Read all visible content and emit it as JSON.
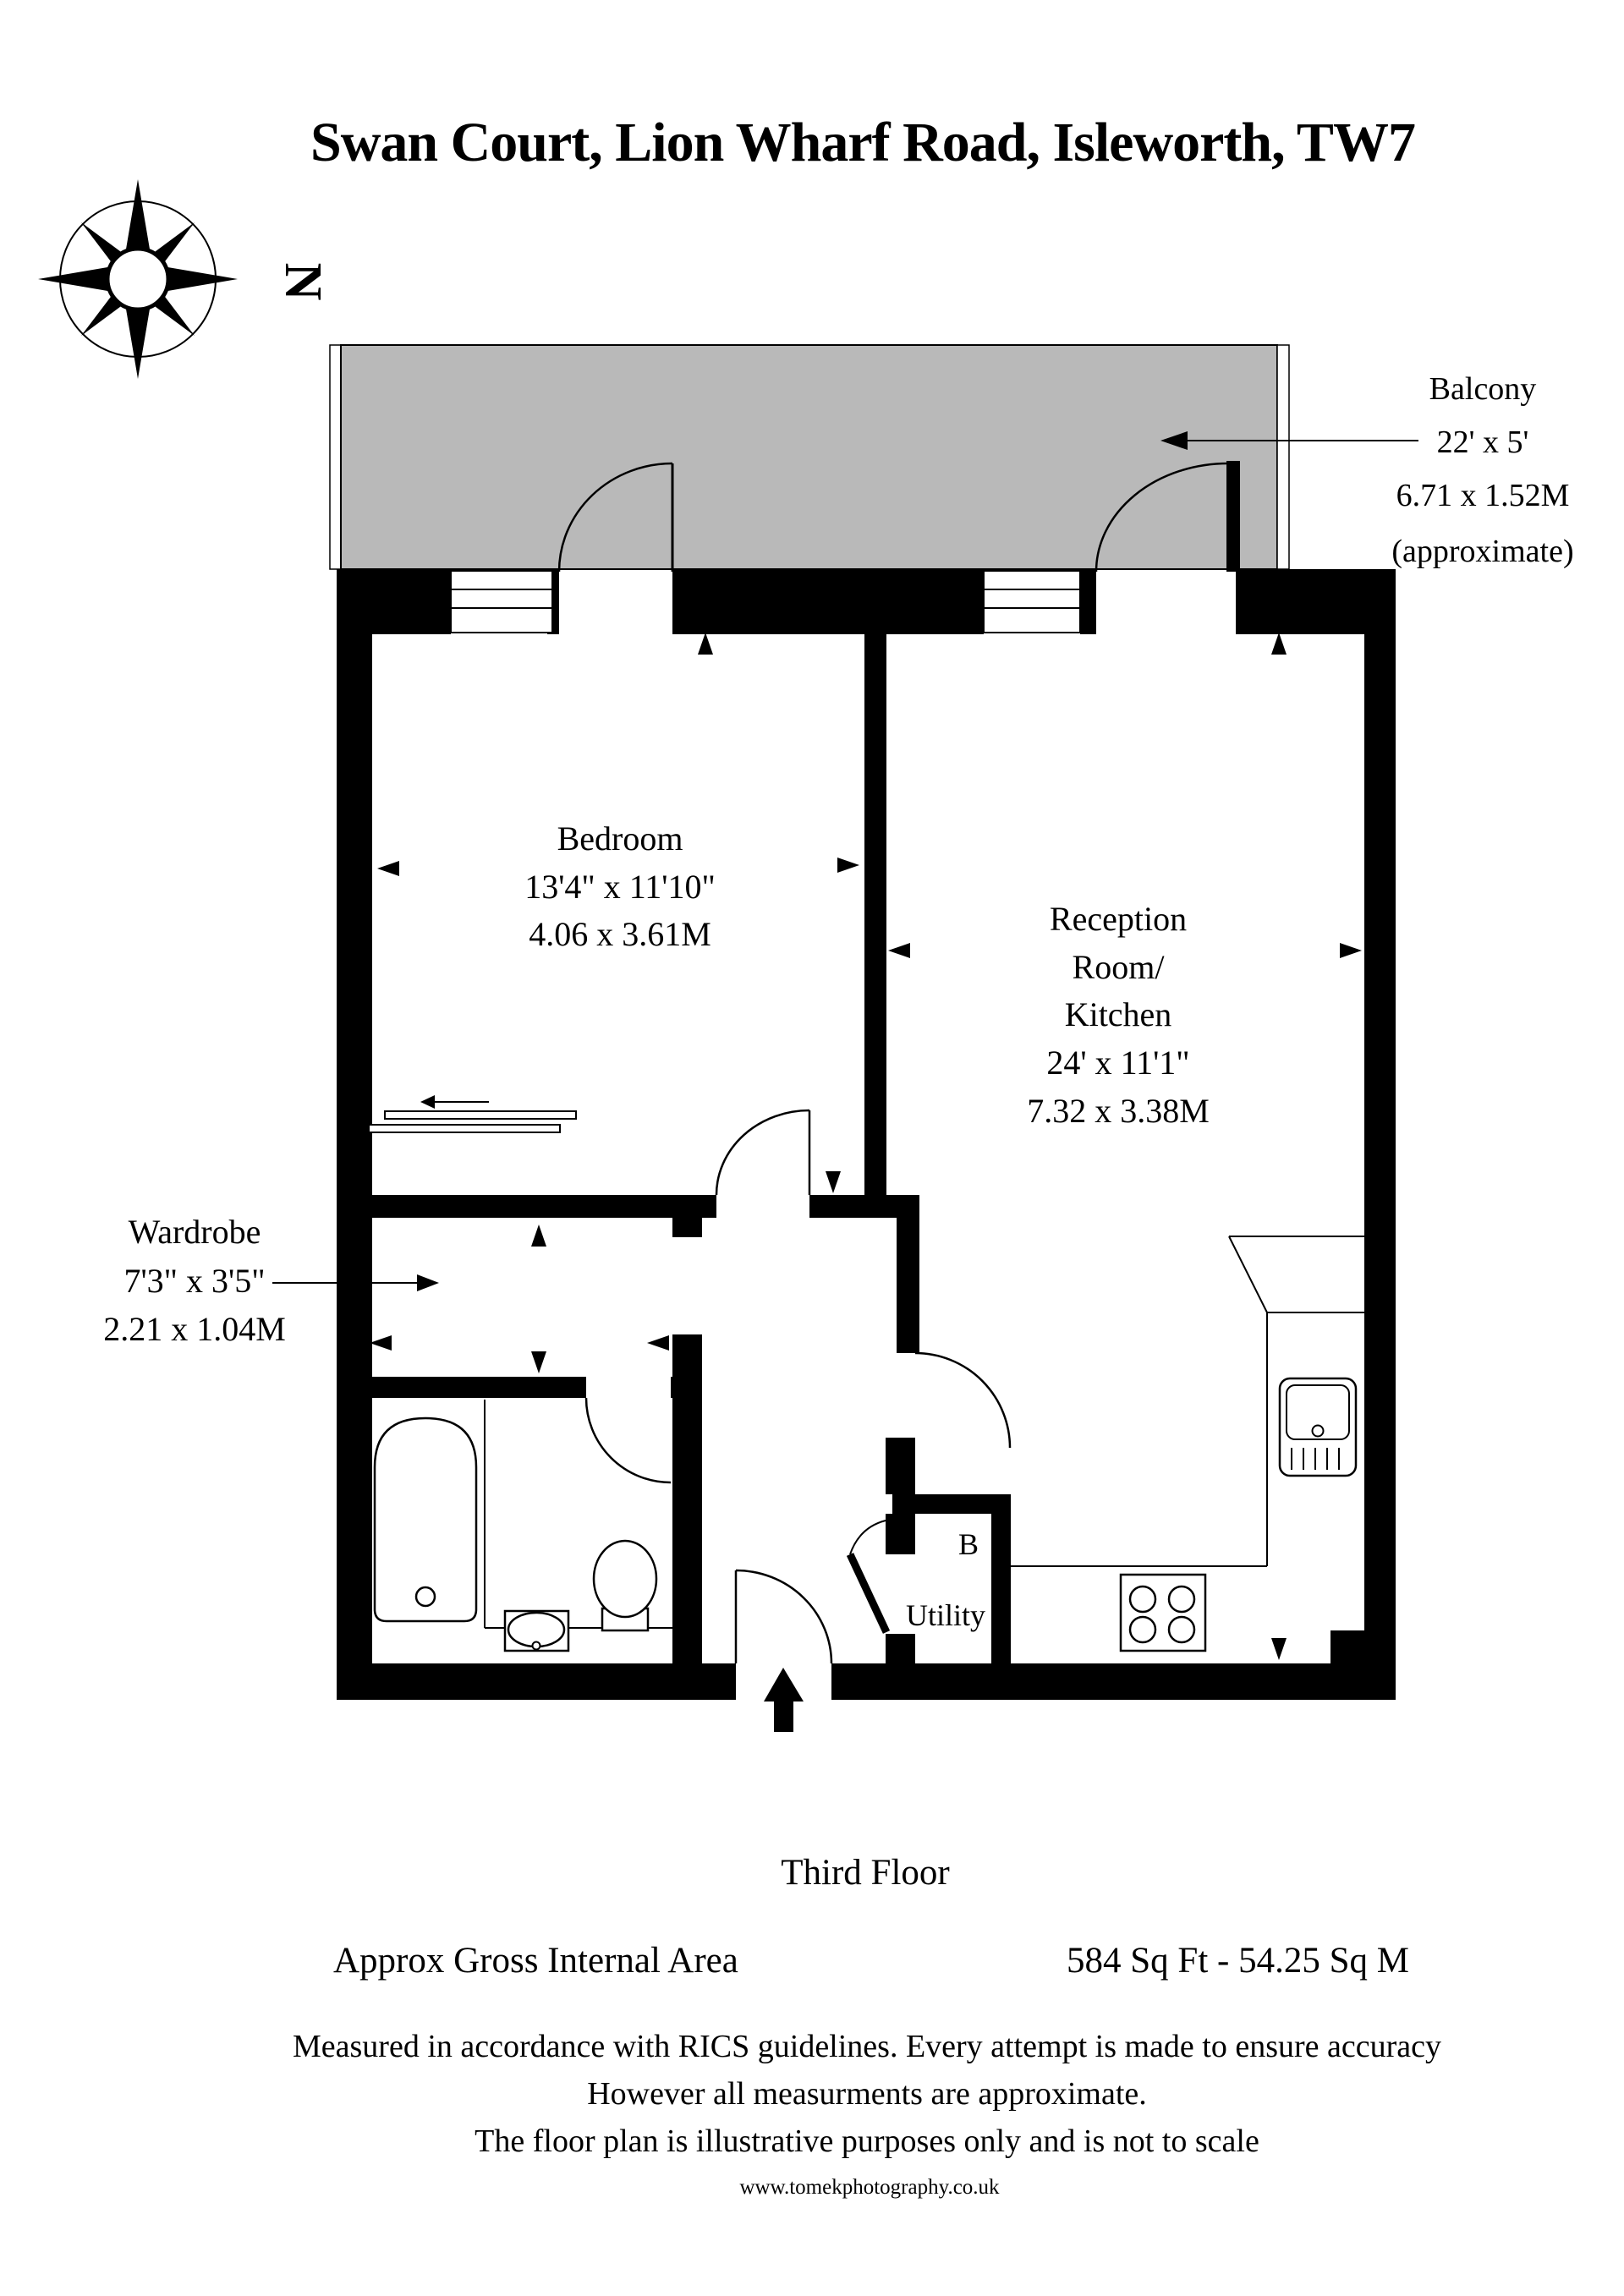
{
  "title": "Swan Court, Lion Wharf Road, Isleworth, TW7",
  "compass": {
    "label": "N"
  },
  "rooms": {
    "balcony": {
      "name": "Balcony",
      "dimensions_ft": "22' x 5'",
      "dimensions_m": "6.71 x 1.52M",
      "note": "(approximate)"
    },
    "bedroom": {
      "name": "Bedroom",
      "dimensions_ft": "13'4\" x 11'10\"",
      "dimensions_m": "4.06 x 3.61M"
    },
    "reception": {
      "name_line1": "Reception",
      "name_line2": "Room/",
      "name_line3": "Kitchen",
      "dimensions_ft": "24' x 11'1\"",
      "dimensions_m": "7.32 x 3.38M"
    },
    "wardrobe": {
      "name": "Wardrobe",
      "dimensions_ft": "7'3\" x 3'5\"",
      "dimensions_m": "2.21 x 1.04M"
    },
    "utility": {
      "label_b": "B",
      "name": "Utility"
    }
  },
  "footer": {
    "floor": "Third Floor",
    "area_label": "Approx Gross Internal Area",
    "area_value": "584 Sq Ft  -  54.25 Sq M",
    "disclaimer_line1": "Measured in accordance with RICS guidelines. Every attempt is made to ensure accuracy",
    "disclaimer_line2": "However all measurments are approximate.",
    "disclaimer_line3": "The floor plan is illustrative purposes only and is not to scale",
    "website": "www.tomekphotography.co.uk"
  },
  "colors": {
    "balcony_fill": "#b9b9b9",
    "wall": "#000000",
    "background": "#ffffff"
  }
}
